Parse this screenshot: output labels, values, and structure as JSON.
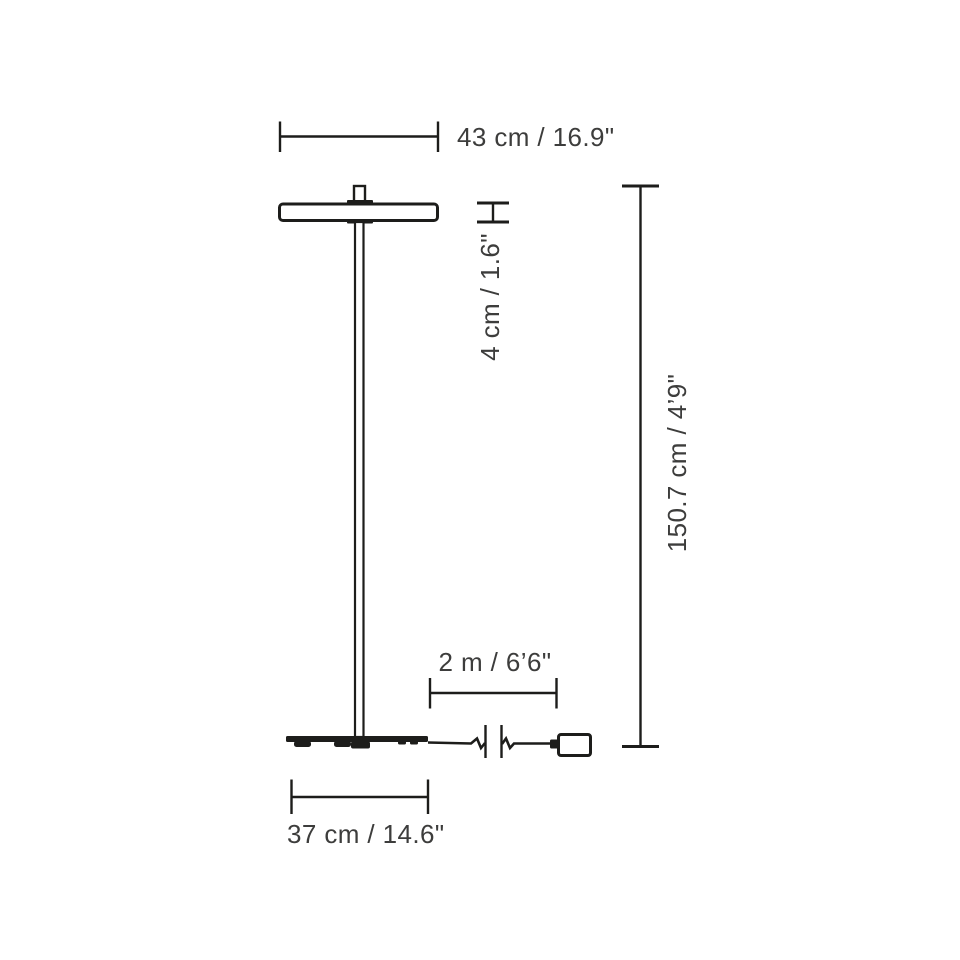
{
  "page": {
    "background": "#ffffff"
  },
  "diagram": {
    "type": "product-dimension-drawing",
    "subject": "floor-lamp-side-view",
    "line_color": "#1d1d1b",
    "text_color": "#3d3d3c",
    "labels": {
      "head_width": "43 cm / 16.9\"",
      "head_height": "4 cm / 1.6\"",
      "total_height": "150.7 cm / 4’9\"",
      "cord_length": "2 m / 6’6\"",
      "base_width": "37 cm / 14.6\""
    }
  }
}
